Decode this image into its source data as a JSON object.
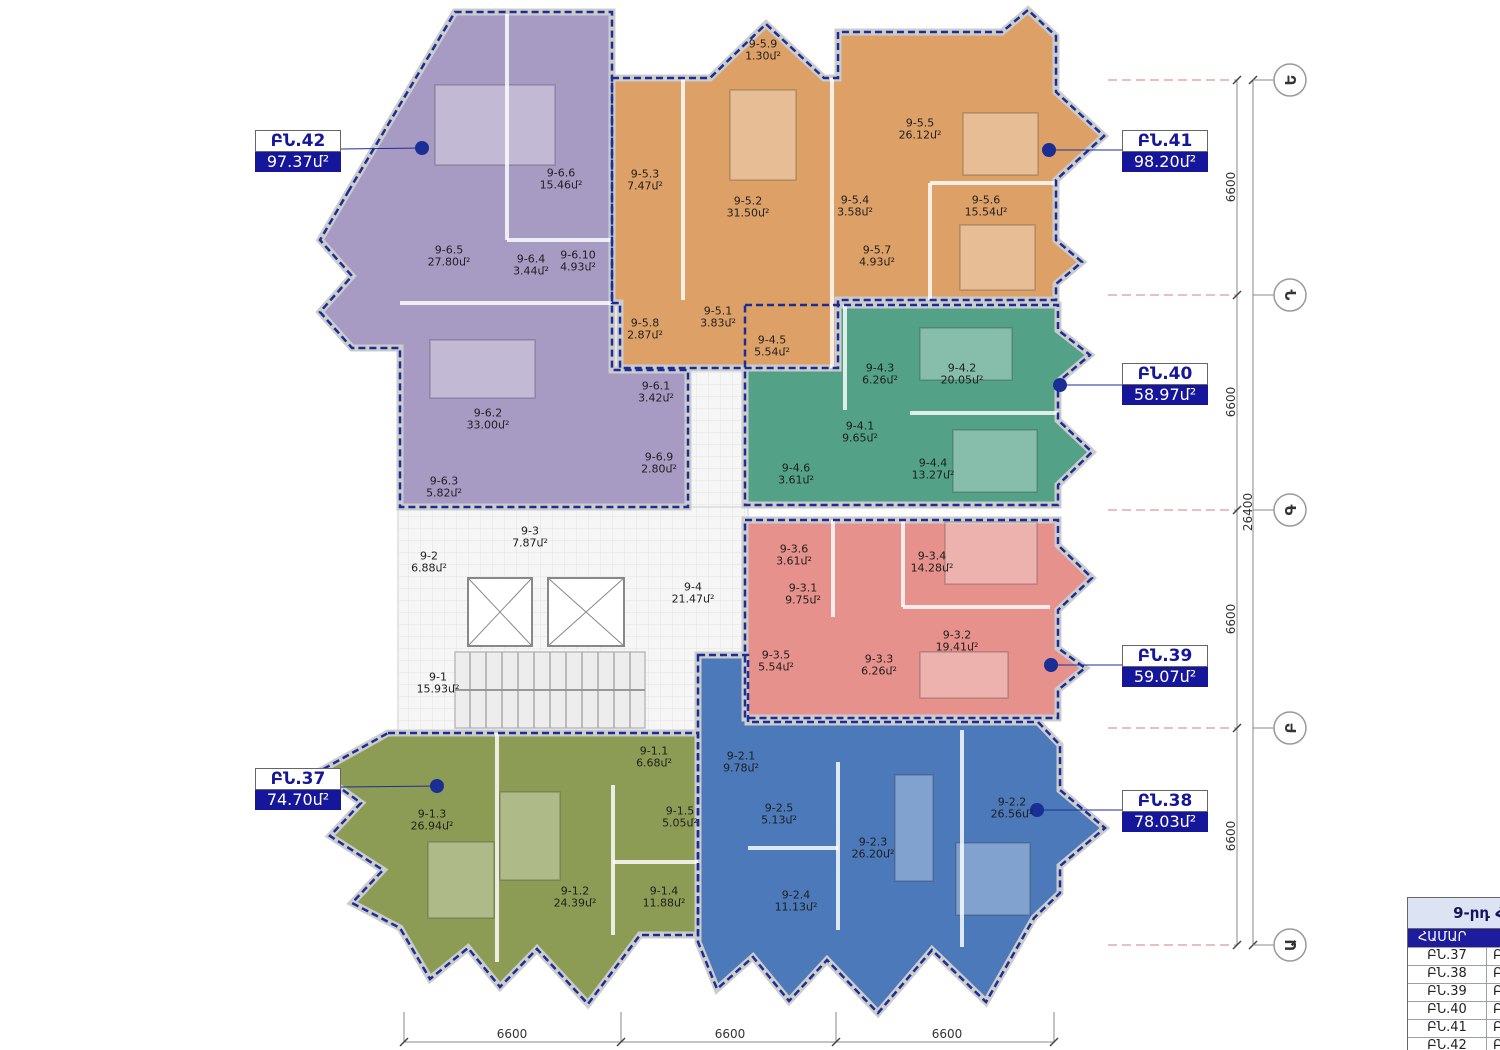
{
  "apartments": [
    {
      "id": "ԲՆ.37",
      "area": "74.70մ²",
      "color": "#8c9c55",
      "rooms": [
        {
          "id": "9-1.1",
          "area": "6.68մ²"
        },
        {
          "id": "9-1.2",
          "area": "24.39մ²"
        },
        {
          "id": "9-1.3",
          "area": "26.94մ²"
        },
        {
          "id": "9-1.4",
          "area": "11.88մ²"
        },
        {
          "id": "9-1.5",
          "area": "5.05մ²"
        }
      ]
    },
    {
      "id": "ԲՆ.38",
      "area": "78.03մ²",
      "color": "#4b79b9",
      "rooms": [
        {
          "id": "9-2.1",
          "area": "9.78մ²"
        },
        {
          "id": "9-2.2",
          "area": "26.56մ²"
        },
        {
          "id": "9-2.3",
          "area": "26.20մ²"
        },
        {
          "id": "9-2.4",
          "area": "11.13մ²"
        },
        {
          "id": "9-2.5",
          "area": "5.13մ²"
        }
      ]
    },
    {
      "id": "ԲՆ.39",
      "area": "59.07մ²",
      "color": "#e6918c",
      "rooms": [
        {
          "id": "9-3.1",
          "area": "9.75մ²"
        },
        {
          "id": "9-3.2",
          "area": "19.41մ²"
        },
        {
          "id": "9-3.3",
          "area": "6.26մ²"
        },
        {
          "id": "9-3.4",
          "area": "14.28մ²"
        },
        {
          "id": "9-3.5",
          "area": "5.54մ²"
        },
        {
          "id": "9-3.6",
          "area": "3.61մ²"
        }
      ]
    },
    {
      "id": "ԲՆ.40",
      "area": "58.97մ²",
      "color": "#53a187",
      "rooms": [
        {
          "id": "9-4.1",
          "area": "9.65մ²"
        },
        {
          "id": "9-4.2",
          "area": "20.05մ²"
        },
        {
          "id": "9-4.3",
          "area": "6.26մ²"
        },
        {
          "id": "9-4.4",
          "area": "13.27մ²"
        },
        {
          "id": "9-4.5",
          "area": "5.54մ²"
        },
        {
          "id": "9-4.6",
          "area": "3.61մ²"
        }
      ]
    },
    {
      "id": "ԲՆ.41",
      "area": "98.20մ²",
      "color": "#dda167",
      "rooms": [
        {
          "id": "9-5.1",
          "area": "3.83մ²"
        },
        {
          "id": "9-5.2",
          "area": "31.50մ²"
        },
        {
          "id": "9-5.3",
          "area": "7.47մ²"
        },
        {
          "id": "9-5.4",
          "area": "3.58մ²"
        },
        {
          "id": "9-5.5",
          "area": "26.12մ²"
        },
        {
          "id": "9-5.6",
          "area": "15.54մ²"
        },
        {
          "id": "9-5.7",
          "area": "4.93մ²"
        },
        {
          "id": "9-5.8",
          "area": "2.87մ²"
        },
        {
          "id": "9-5.9",
          "area": "1.30մ²"
        }
      ]
    },
    {
      "id": "ԲՆ.42",
      "area": "97.37մ²",
      "color": "#a89bc3",
      "rooms": [
        {
          "id": "9-6.1",
          "area": "3.42մ²"
        },
        {
          "id": "9-6.2",
          "area": "33.00մ²"
        },
        {
          "id": "9-6.3",
          "area": "5.82մ²"
        },
        {
          "id": "9-6.4",
          "area": "3.44մ²"
        },
        {
          "id": "9-6.5",
          "area": "27.80մ²"
        },
        {
          "id": "9-6.6",
          "area": "15.46մ²"
        },
        {
          "id": "9-6.9",
          "area": "2.80մ²"
        },
        {
          "id": "9-6.10",
          "area": "4.93մ²"
        }
      ]
    }
  ],
  "core": {
    "rooms": [
      {
        "id": "9-1",
        "area": "15.93մ²"
      },
      {
        "id": "9-2",
        "area": "6.88մ²"
      },
      {
        "id": "9-3",
        "area": "7.87մ²"
      },
      {
        "id": "9-4",
        "area": "21.47մ²"
      }
    ]
  },
  "dims": {
    "right": [
      "6600",
      "6600",
      "6600",
      "6600"
    ],
    "right_total": "26400",
    "bottom": [
      "6600",
      "6600",
      "6600"
    ]
  },
  "grid_letters": [
    "Ե",
    "Դ",
    "Գ",
    "Բ",
    "Ա"
  ],
  "legend_table": {
    "title": "9-րդ ՀԱՐԿԻ",
    "col_header": "ՀԱՄԱՐ",
    "rows": [
      {
        "unit": "ԲՆ.37",
        "value": "ԲՆ"
      },
      {
        "unit": "ԲՆ.38",
        "value": "ԲՆ"
      },
      {
        "unit": "ԲՆ.39",
        "value": "ԲՆ"
      },
      {
        "unit": "ԲՆ.40",
        "value": "ԲՆ"
      },
      {
        "unit": "ԲՆ.41",
        "value": "ԲՆ"
      },
      {
        "unit": "ԲՆ.42",
        "value": "ԲՆ"
      }
    ]
  },
  "colors": {
    "boundary": "#1b2e96",
    "badge": "#16169a"
  }
}
